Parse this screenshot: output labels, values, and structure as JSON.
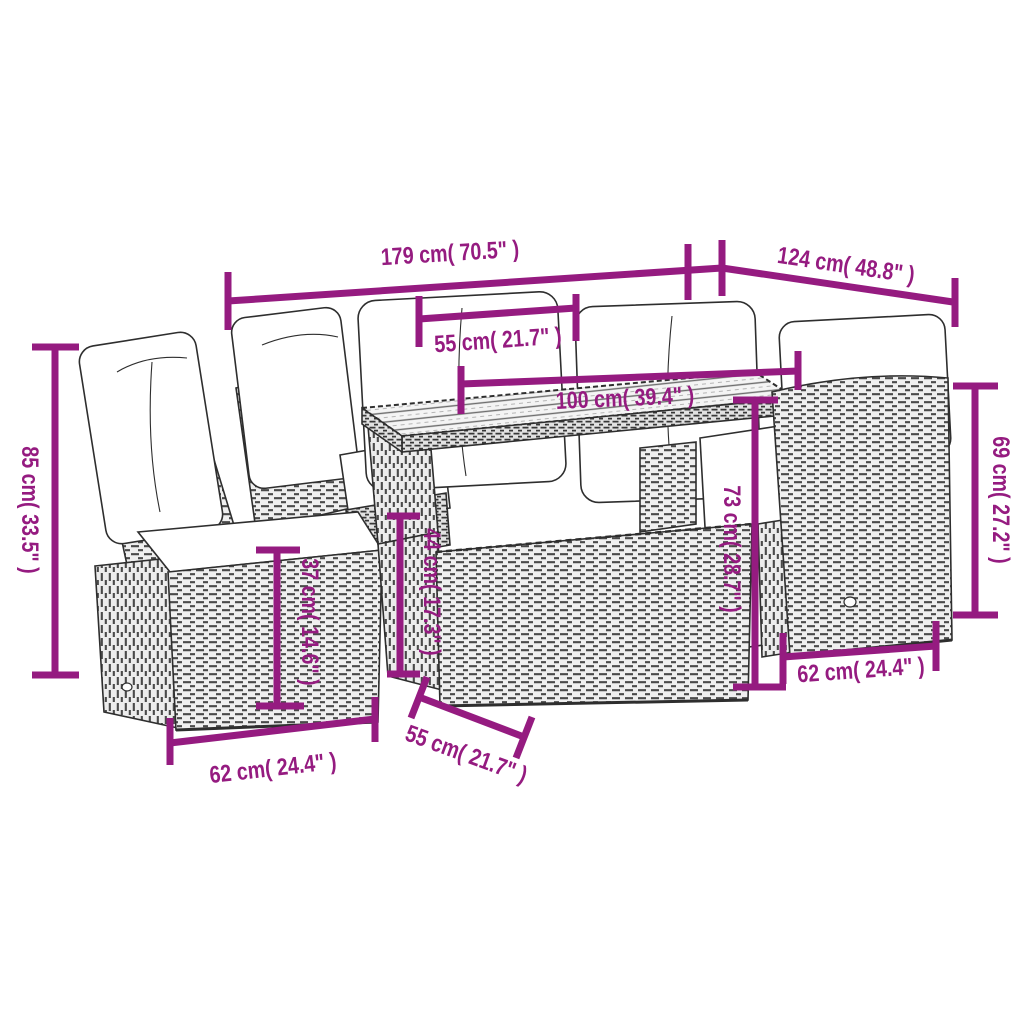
{
  "page": {
    "background": "#ffffff"
  },
  "diagram": {
    "accent_color": "#951B80",
    "outline_color": "#2e2e2e",
    "subject": "rattan-garden-furniture-set-with-table",
    "dimensions": {
      "d179": {
        "label": "179 cm( 70.5\" )"
      },
      "d124": {
        "label": "124 cm( 48.8\" )"
      },
      "d55_top": {
        "label": "55 cm( 21.7\" )"
      },
      "d100": {
        "label": "100 cm( 39.4\" )"
      },
      "d85": {
        "label": "85 cm( 33.5\" )"
      },
      "d37": {
        "label": "37 cm( 14.6\" )"
      },
      "d44": {
        "label": "44 cm( 17.3\" )"
      },
      "d73": {
        "label": "73 cm( 28.7\" )"
      },
      "d69": {
        "label": "69 cm( 27.2\" )"
      },
      "d62_left": {
        "label": "62 cm( 24.4\" )"
      },
      "d55_bottom": {
        "label": "55 cm( 21.7\" )"
      },
      "d62_right": {
        "label": "62 cm( 24.4\" )"
      }
    }
  }
}
